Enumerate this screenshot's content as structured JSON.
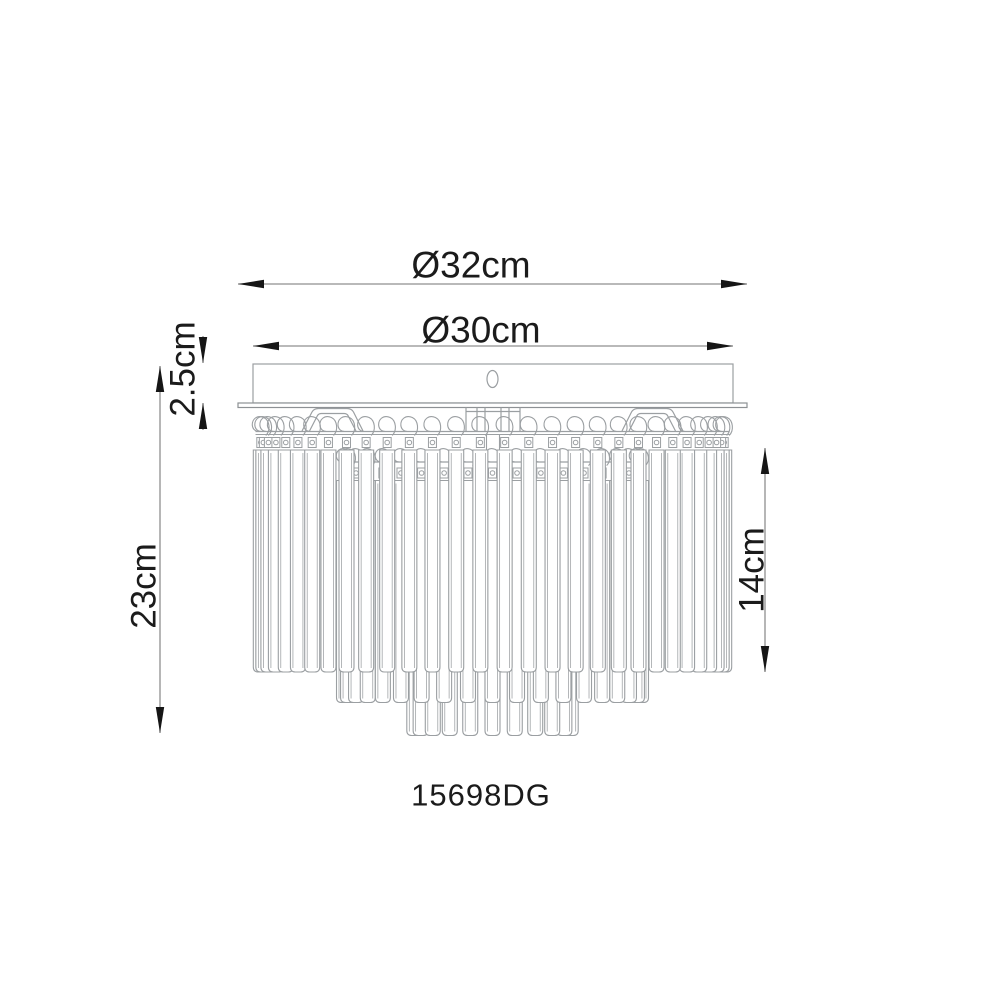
{
  "drawing": {
    "type": "technical-dimension-diagram",
    "subject": "flush-mount crystal ceiling lamp, side elevation",
    "product_code": "15698DG",
    "dimensions": {
      "outer_diameter": "Ø32cm",
      "canopy_diameter": "Ø30cm",
      "canopy_height": "2.5cm",
      "total_height": "23cm",
      "crystal_length": "14cm"
    },
    "colors": {
      "background": "#ffffff",
      "fixture_line": "#9b9fa2",
      "dimension_line": "#8f8f8f",
      "arrow": "#161616",
      "text": "#1b1b1b"
    }
  }
}
